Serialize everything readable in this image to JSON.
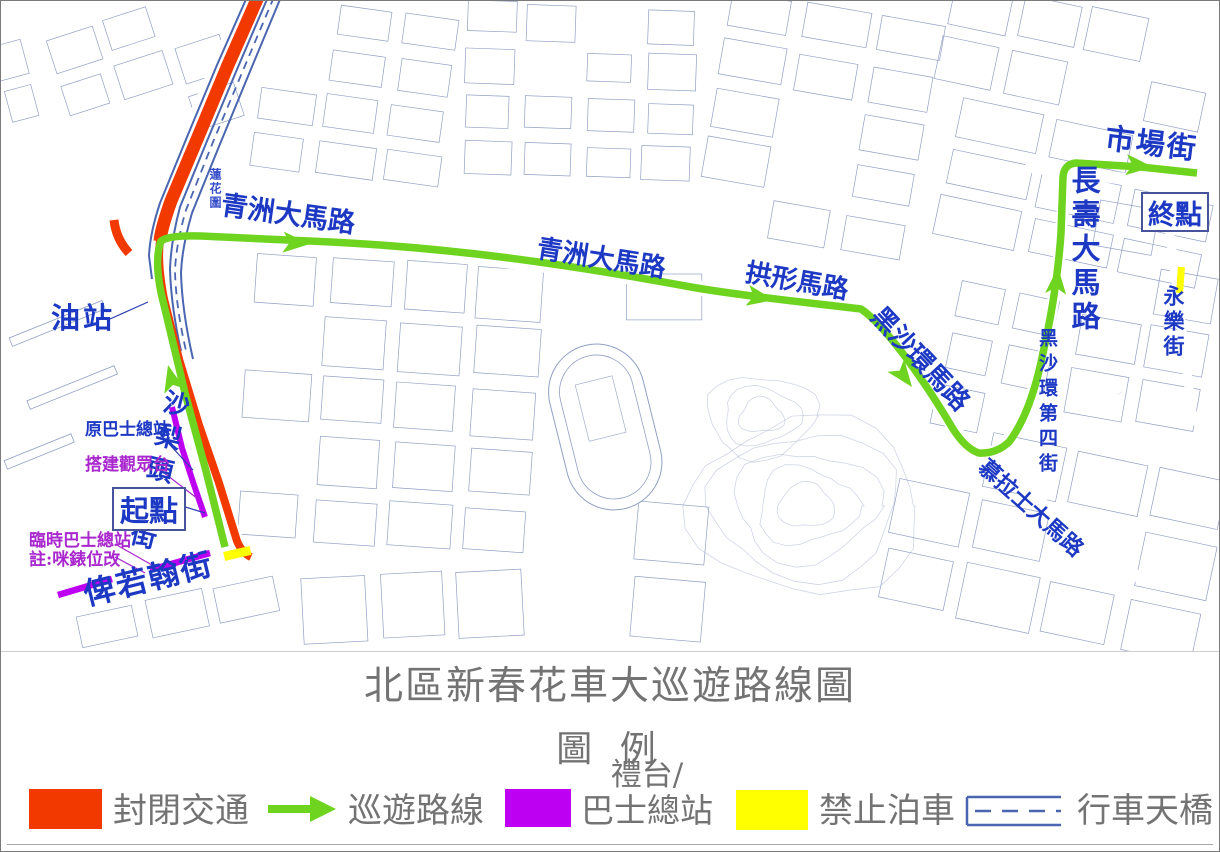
{
  "title": "北區新春花車大巡遊路線圖",
  "legend": {
    "heading": "圖 例",
    "items": [
      {
        "label": "封閉交通",
        "swatch": "closed-traffic"
      },
      {
        "label": "巡遊路線",
        "swatch": "parade-route-arrow"
      },
      {
        "label": "禮台/",
        "label2": "巴士總站",
        "swatch": "stage-bus-terminal"
      },
      {
        "label": "禁止泊車",
        "swatch": "no-parking"
      },
      {
        "label": "行車天橋",
        "swatch": "vehicle-flyover"
      }
    ]
  },
  "map": {
    "street_labels": {
      "qingzhou1": "青洲大馬路",
      "qingzhou2": "青洲大馬路",
      "gongxing": "拱形馬路",
      "heishahuan": "黑沙環馬路",
      "heisha4": "黑沙環第四街",
      "mulashi": "慕拉士大馬路",
      "changshou": "長壽大馬路",
      "shichang": "市場街",
      "yongle": "永樂街",
      "shalitou": "沙梨頭北街",
      "beiruohan": "俾若翰街",
      "lianhua": "蓮花圍"
    },
    "poi_labels": {
      "gas_station": "油站",
      "start": "起點",
      "end": "終點",
      "former_bus_terminal": "原巴士總站",
      "spectator_stand": "搭建觀眾台",
      "temp_bus_terminal": "臨時巴士總站",
      "meter_note": "註:咪錶位改"
    }
  },
  "colors": {
    "closed": "#F23A00",
    "route": "#6FD41F",
    "stage": "#BE00F2",
    "no_parking": "#FFFF00",
    "flyover": "#4A66B0",
    "street_label": "#1D39C4",
    "purple_label": "#A928CE",
    "caption_grey": "#737373"
  }
}
